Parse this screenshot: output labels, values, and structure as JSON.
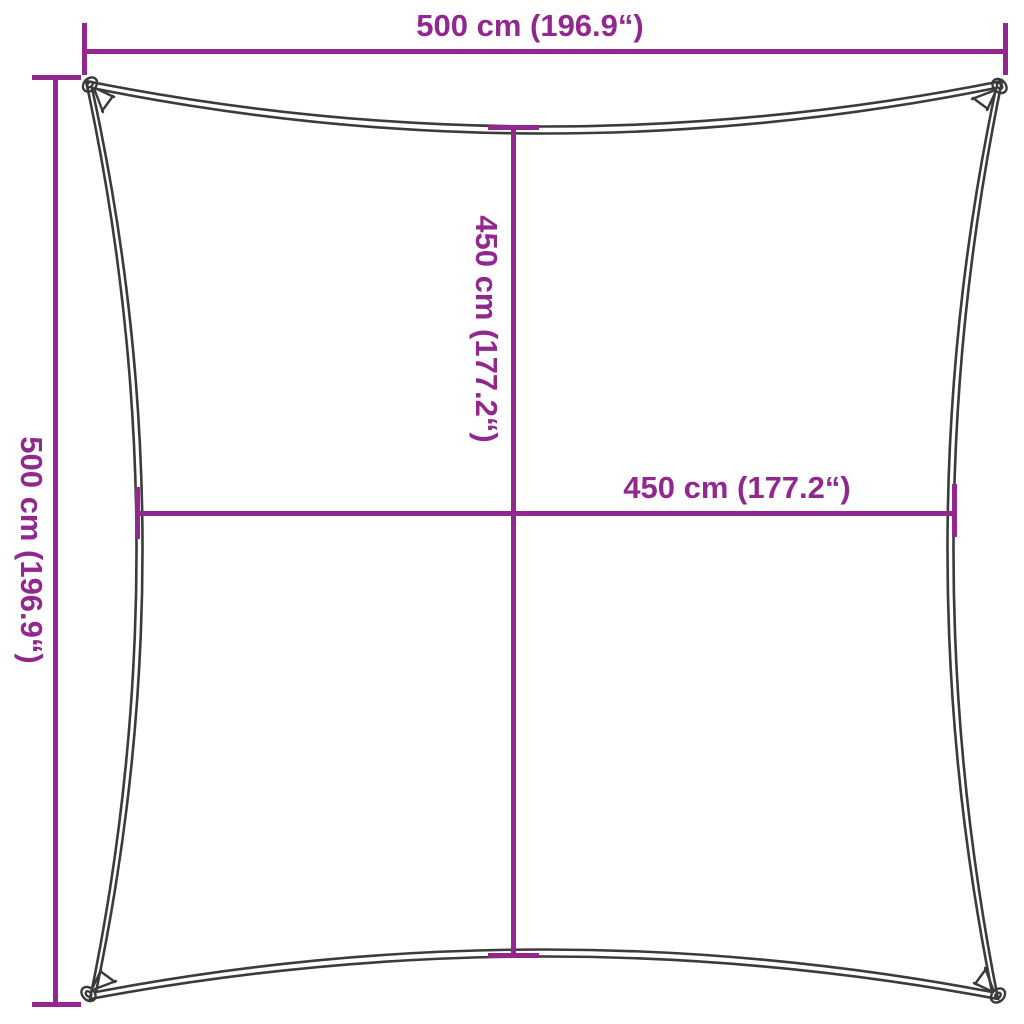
{
  "diagram": {
    "kind": "product-dimension-diagram",
    "shape": "square-shade-sail",
    "background_color": "#FFFFFF",
    "accent_color": "#92278F",
    "outline_color": "#3B3B3B",
    "dimensions": {
      "top_edge": {
        "label": "500 cm (196.9“)",
        "cm": "500",
        "inches": "196.9"
      },
      "left_edge": {
        "label": "500 cm (196.9“)",
        "cm": "500",
        "inches": "196.9"
      },
      "inner_vertical": {
        "label": "450 cm (177.2“)",
        "cm": "450",
        "inches": "177.2"
      },
      "inner_horizontal": {
        "label": "450 cm (177.2“)",
        "cm": "450",
        "inches": "177.2"
      }
    }
  }
}
